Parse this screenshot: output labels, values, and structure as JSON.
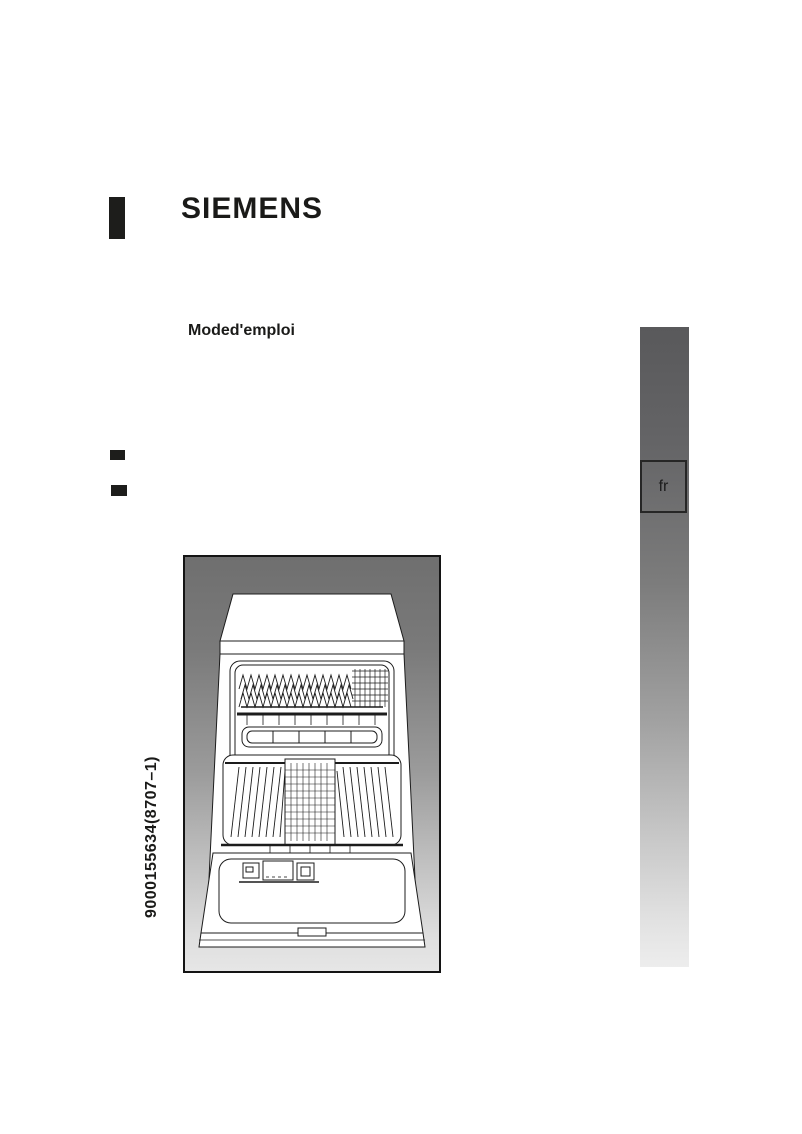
{
  "page": {
    "brand": "SIEMENS",
    "subtitle": "Moded'emploi",
    "part_number": "9000155634(8707–1)",
    "language_tab": "fr"
  },
  "illustration": {
    "name": "dishwasher-front-open-illustration"
  },
  "colors": {
    "brand_text": "#1a1a18",
    "frame_gradient_top": "#6f6f6f",
    "frame_gradient_bottom": "#e6e6e6",
    "lang_bar_gradient_top": "#59595b",
    "lang_bar_gradient_bottom": "#ededed"
  }
}
